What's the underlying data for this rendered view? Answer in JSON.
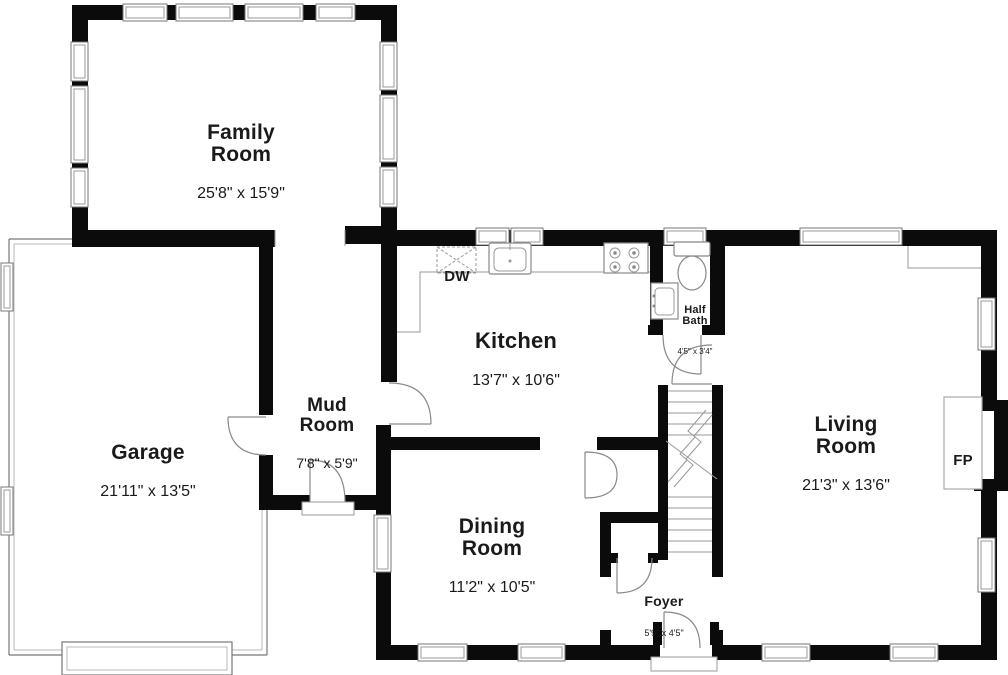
{
  "rooms": {
    "family_room": {
      "name": "Family\nRoom",
      "dims": "25'8\" x 15'9\""
    },
    "garage": {
      "name": "Garage",
      "dims": "21'11\" x 13'5\""
    },
    "mud_room": {
      "name": "Mud\nRoom",
      "dims": "7'8\" x 5'9\""
    },
    "kitchen": {
      "name": "Kitchen",
      "dims": "13'7\" x 10'6\""
    },
    "dining_room": {
      "name": "Dining\nRoom",
      "dims": "11'2\" x 10'5\""
    },
    "half_bath": {
      "name": "Half\nBath",
      "dims": "4'5\" x 3'4\""
    },
    "living_room": {
      "name": "Living\nRoom",
      "dims": "21'3\" x 13'6\""
    },
    "foyer": {
      "name": "Foyer",
      "dims": "5'9\" x 4'5\""
    }
  },
  "fixtures": {
    "dishwasher": "DW",
    "fireplace": "FP"
  },
  "colors": {
    "wall": "#0b0b0b",
    "thin_line": "#8a8a8a",
    "text": "#1a1a1a",
    "background": "#ffffff"
  }
}
